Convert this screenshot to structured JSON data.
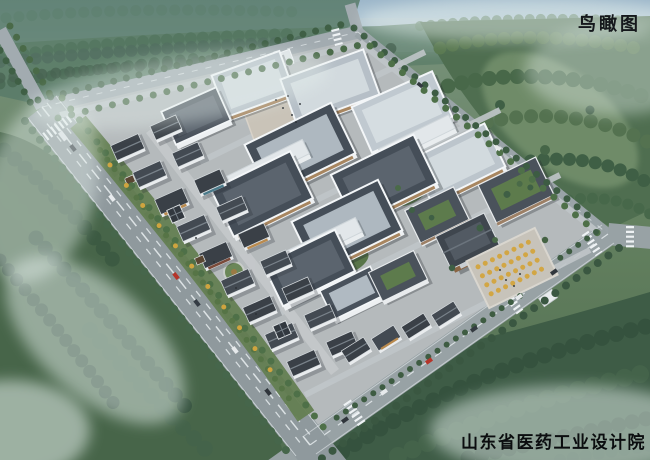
{
  "overlay": {
    "view_label": "鸟瞰图",
    "studio_label": "山东省医药工业设计院"
  },
  "palette": {
    "sky": "#9db7ca",
    "haze": "#cfe0e2",
    "forest_dark": "#35523e",
    "forest_mid": "#4e7048",
    "moss": "#7d9873",
    "road": "#8f999d",
    "road_marking": "#e8eef0",
    "campus_ground": "#b5babc",
    "factory_wall": "#edf0f2",
    "factory_roof_dark": "#454e58",
    "factory_roof_light": "#b6bfc7",
    "traditional_roof": "#3a4047",
    "admin_wood": "#8a6544",
    "ginkgo_gold": "#d2a644",
    "plaza_paving": "#c9c3b8"
  }
}
